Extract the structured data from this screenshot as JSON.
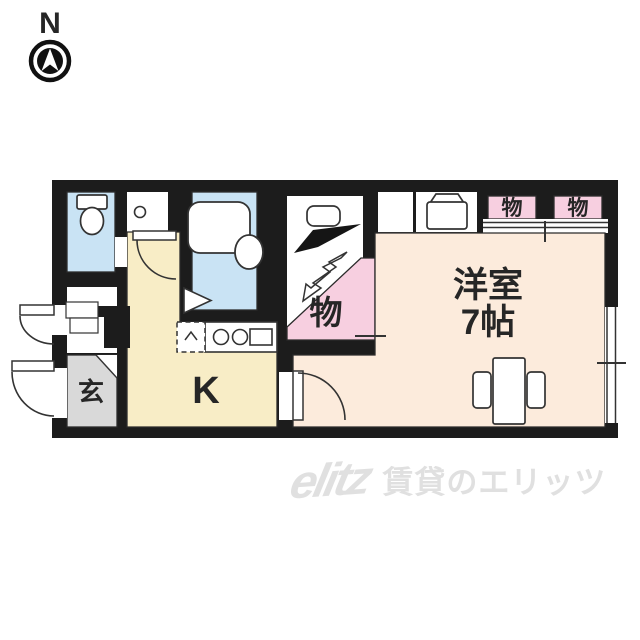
{
  "compass": {
    "label": "N"
  },
  "floor_plan": {
    "rooms": {
      "entrance": {
        "label": "玄"
      },
      "kitchen": {
        "label": "K"
      },
      "western_room": {
        "label_line1": "洋室",
        "label_line2": "7帖"
      },
      "closet_middle": {
        "label": "物"
      },
      "closet_top_left": {
        "label": "物"
      },
      "closet_top_right": {
        "label": "物"
      }
    },
    "colors": {
      "wall": "#1c1c1c",
      "water_blue": "#c9e3f4",
      "kitchen_cream": "#f8edc6",
      "room_peach": "#fcebdc",
      "closet_pink": "#f7cfe0",
      "entrance_gray": "#d9d9d9"
    }
  },
  "watermark": {
    "logo": "elitz",
    "text": "賃貸のエリッツ"
  }
}
